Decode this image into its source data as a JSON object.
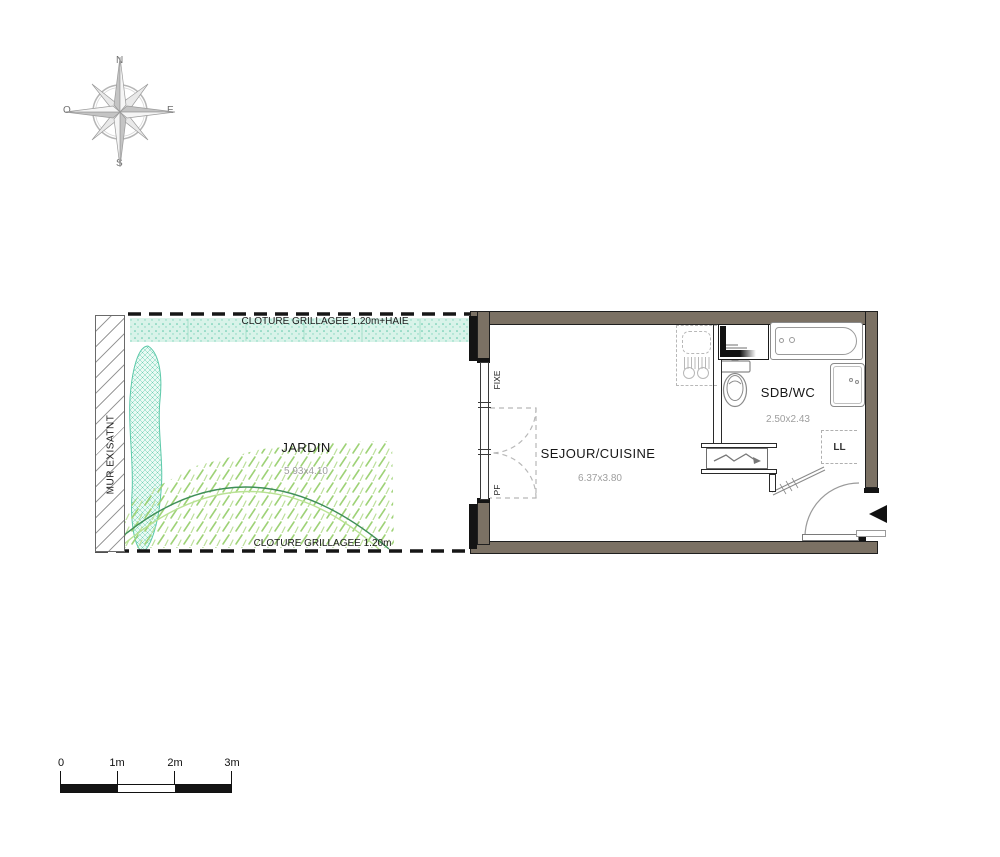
{
  "colors": {
    "wall": "#7b7164",
    "wallEdge": "#1f1f1f",
    "hedgeBg": "#d9f3e9",
    "hedgeDot": "#56c5a5",
    "grass": "#9ed277",
    "arcDark": "#3f8f58",
    "arcLight": "#b9e293",
    "fixture": "#8a8a8a",
    "fenceDash": "#161616",
    "dimText": "#9e9e9e",
    "kitchenDash": "#b8b8b8"
  },
  "compass": {
    "north": "N",
    "east": "E",
    "south": "S",
    "west": "O"
  },
  "garden": {
    "label": "JARDIN",
    "dimensions": "5.93x4.10",
    "fence_top": "CLOTURE GRILLAGEE 1.20m+HAIE",
    "fence_bottom": "CLOTURE GRILLAGEE 1.20m",
    "wall_label": "MUR EXISATNT"
  },
  "living": {
    "label": "SEJOUR/CUISINE",
    "dimensions": "6.37x3.80",
    "window_fixed": "FIXE",
    "window_door": "PF"
  },
  "bathroom": {
    "label": "SDB/WC",
    "dimensions": "2.50x2.43",
    "washer": "LL"
  },
  "scale_bar": {
    "ticks": [
      "0",
      "1m",
      "2m",
      "3m"
    ]
  }
}
